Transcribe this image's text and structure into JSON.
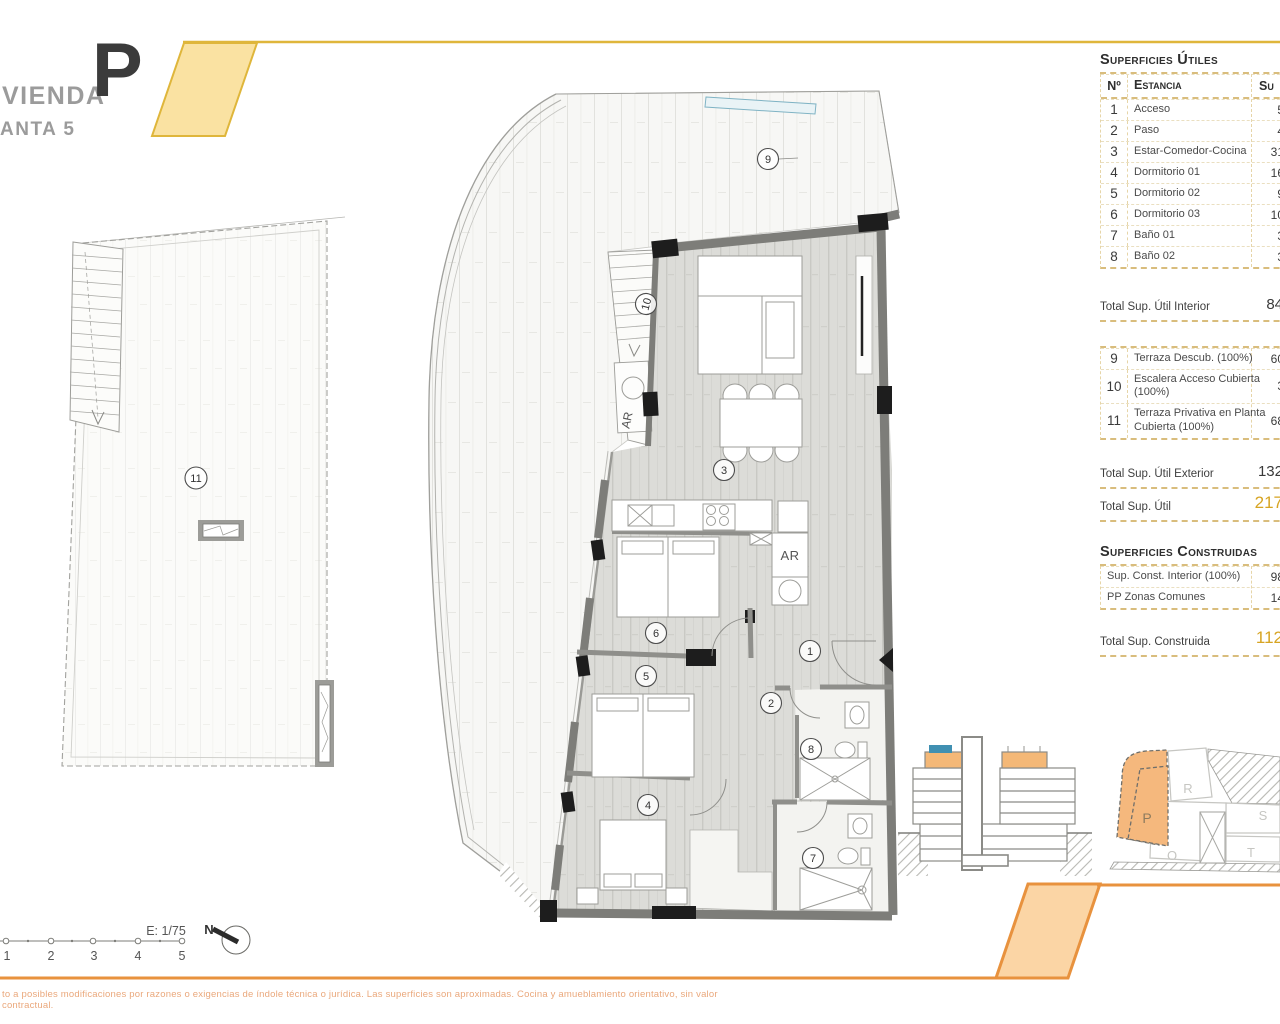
{
  "header": {
    "project": "VIENDA",
    "level": "ANTA 5",
    "unit": "P"
  },
  "surfaces_utiles": {
    "title": "Superficies Útiles",
    "columns": {
      "no": "Nº",
      "room": "Estancia",
      "area": "Su"
    },
    "rows": [
      {
        "no": "1",
        "name": "Acceso",
        "value": "5"
      },
      {
        "no": "2",
        "name": "Paso",
        "value": "4"
      },
      {
        "no": "3",
        "name": "Estar-Comedor-Cocina",
        "value": "31"
      },
      {
        "no": "4",
        "name": "Dormitorio 01",
        "value": "16"
      },
      {
        "no": "5",
        "name": "Dormitorio 02",
        "value": "9"
      },
      {
        "no": "6",
        "name": "Dormitorio 03",
        "value": "10"
      },
      {
        "no": "7",
        "name": "Baño 01",
        "value": "3"
      },
      {
        "no": "8",
        "name": "Baño 02",
        "value": "3"
      }
    ],
    "total_interior": {
      "label": "Total Sup. Útil Interior",
      "value": "84"
    },
    "exterior_rows": [
      {
        "no": "9",
        "name": "Terraza Descub. (100%)",
        "value": "60"
      },
      {
        "no": "10",
        "name": "Escalera Acceso Cubierta (100%)",
        "value": "3"
      },
      {
        "no": "11",
        "name": "Terraza Privativa en Planta Cubierta (100%)",
        "value": "68"
      }
    ],
    "total_exterior": {
      "label": "Total Sup. Útil Exterior",
      "value": "132"
    },
    "total": {
      "label": "Total Sup. Útil",
      "value": "217"
    }
  },
  "surfaces_construidas": {
    "title": "Superficies Construidas",
    "rows": [
      {
        "name": "Sup. Const. Interior (100%)",
        "value": "98"
      },
      {
        "name": "PP Zonas Comunes",
        "value": "14"
      }
    ],
    "total": {
      "label": "Total Sup. Construida",
      "value": "112"
    }
  },
  "plan": {
    "labels": {
      "1": "1",
      "2": "2",
      "3": "3",
      "4": "4",
      "5": "5",
      "6": "6",
      "7": "7",
      "8": "8",
      "9": "9",
      "10": "10",
      "11": "11"
    },
    "closet": "AR"
  },
  "site": {
    "units": {
      "p": "P",
      "r": "R",
      "s": "S",
      "o": "O",
      "t": "T"
    }
  },
  "footer": {
    "scale": "E: 1/75",
    "ticks": [
      "1",
      "2",
      "3",
      "4",
      "5"
    ],
    "north": "N",
    "disclaimer": "to a posibles modificaciones por razones o exigencias de índole técnica o jurídica. Las superficies son aproximadas. Cocina y amueblamiento orientativo, sin valor contractual."
  },
  "colors": {
    "accent_gold": "#dfb63b",
    "accent_orange": "#e8923e",
    "unit_highlight": "#f5b87d",
    "total_value": "#d7a422",
    "glass_blue": "#7fb3c4"
  }
}
